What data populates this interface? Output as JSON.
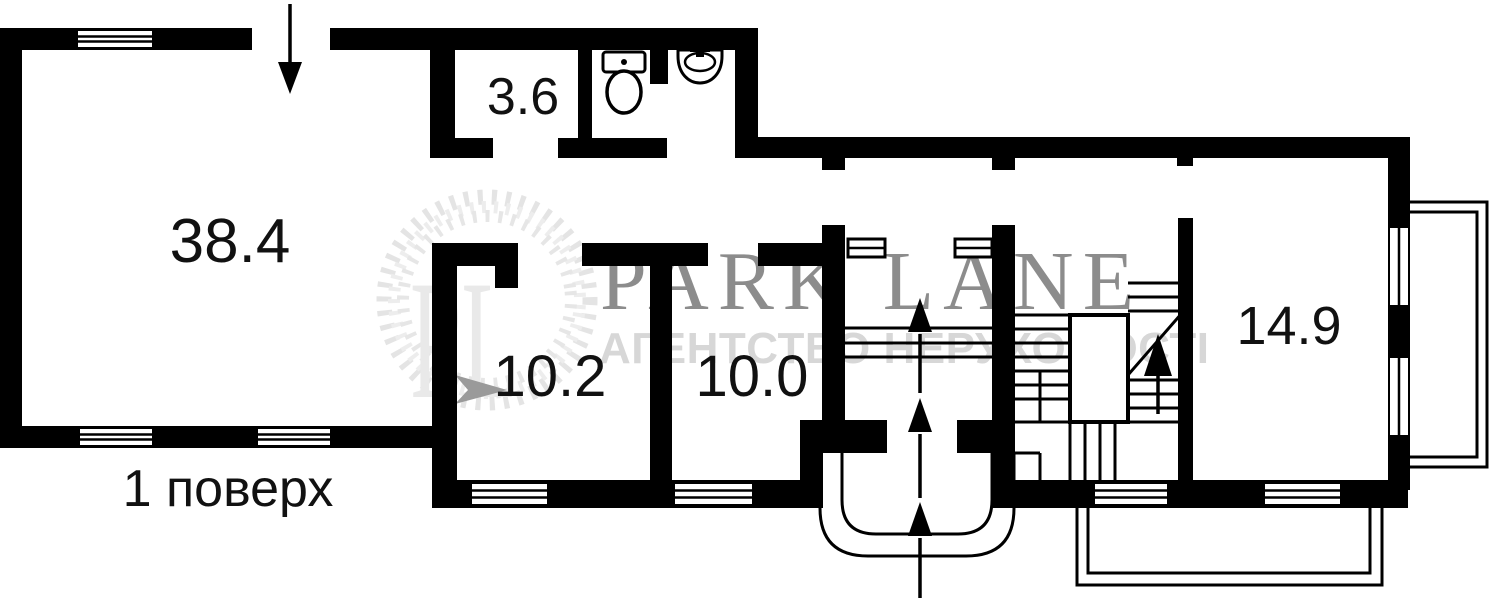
{
  "title": "Floor plan — first floor",
  "floor_label": "1 поверх",
  "rooms": [
    {
      "name": "living-room",
      "area": "38.4"
    },
    {
      "name": "bathroom",
      "area": "3.6"
    },
    {
      "name": "room-left",
      "area": "10.2"
    },
    {
      "name": "room-middle",
      "area": "10.0"
    },
    {
      "name": "room-right",
      "area": "14.9"
    }
  ],
  "watermark": {
    "monogram": "PL",
    "brand": "PARK LANE",
    "tagline": "АГЕНТСТВО НЕРУХОМОСТІ"
  },
  "icons": [
    "toilet-icon",
    "sink-icon",
    "entrance-arrow-icon",
    "stairs-up-arrow-icon",
    "porch-steps-icon",
    "window-icon",
    "laurel-wreath-icon"
  ],
  "colors": {
    "walls": "#000000",
    "background": "#ffffff",
    "watermark_light": "#e7e7e7",
    "watermark_brand": "#747474",
    "watermark_tagline": "#d7d7d7",
    "labels": "#111111"
  }
}
